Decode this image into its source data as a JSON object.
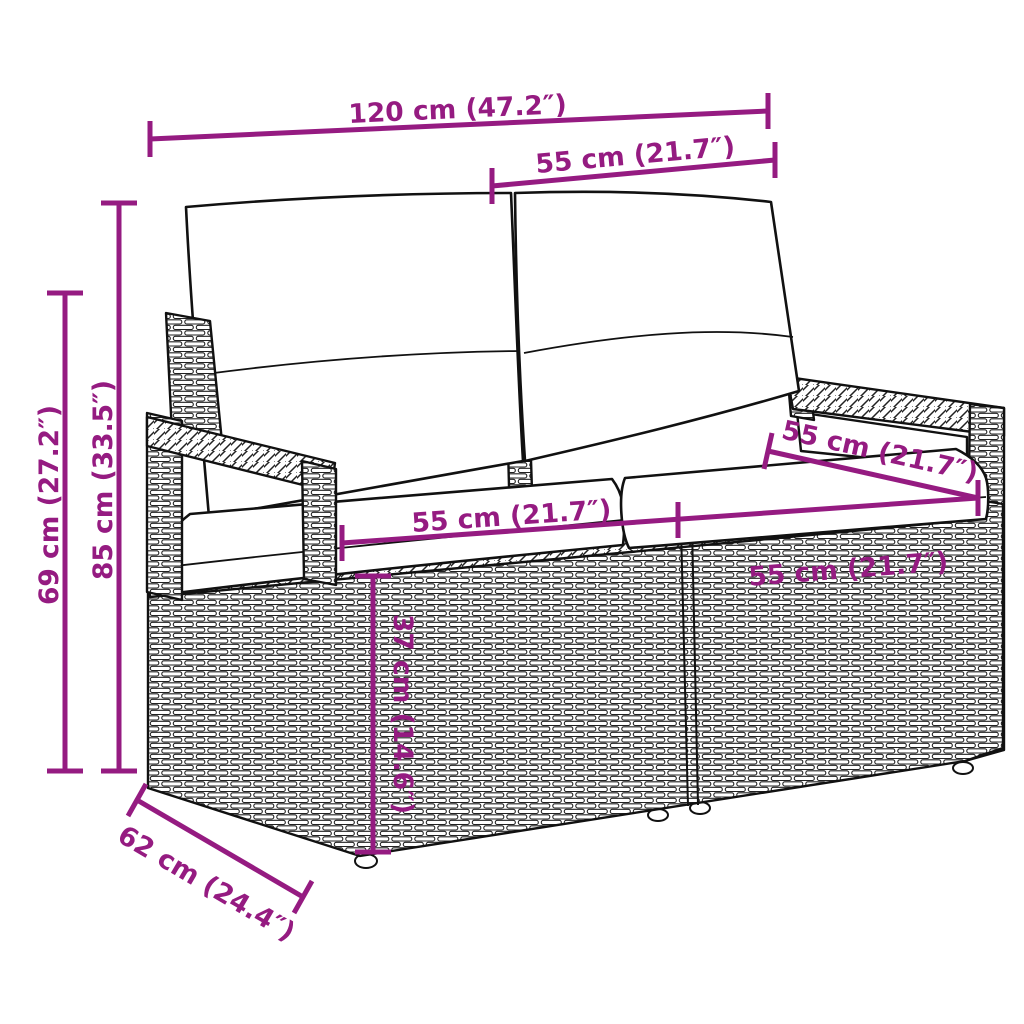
{
  "diagram": {
    "type": "product-dimension-diagram",
    "subject": "poly rattan 2-seater garden sofa with cushions, line art",
    "accent_color": "#951b81",
    "stroke_color": "#111111",
    "background": "#ffffff",
    "dimensions": {
      "overall_width": {
        "label": "120 cm (47.2″)"
      },
      "seat_top_width": {
        "label": "55 cm (21.7″)"
      },
      "overall_height": {
        "label": "85 cm (33.5″)"
      },
      "armrest_height": {
        "label": "69 cm (27.2″)"
      },
      "seat_width_left": {
        "label": "55 cm (21.7″)"
      },
      "seat_width_right": {
        "label": "55 cm (21.7″)"
      },
      "seat_depth_right": {
        "label": "55 cm (21.7″)"
      },
      "seat_height": {
        "label": "37 cm (14.6″)"
      },
      "base_depth": {
        "label": "62 cm (24.4″)"
      }
    }
  }
}
